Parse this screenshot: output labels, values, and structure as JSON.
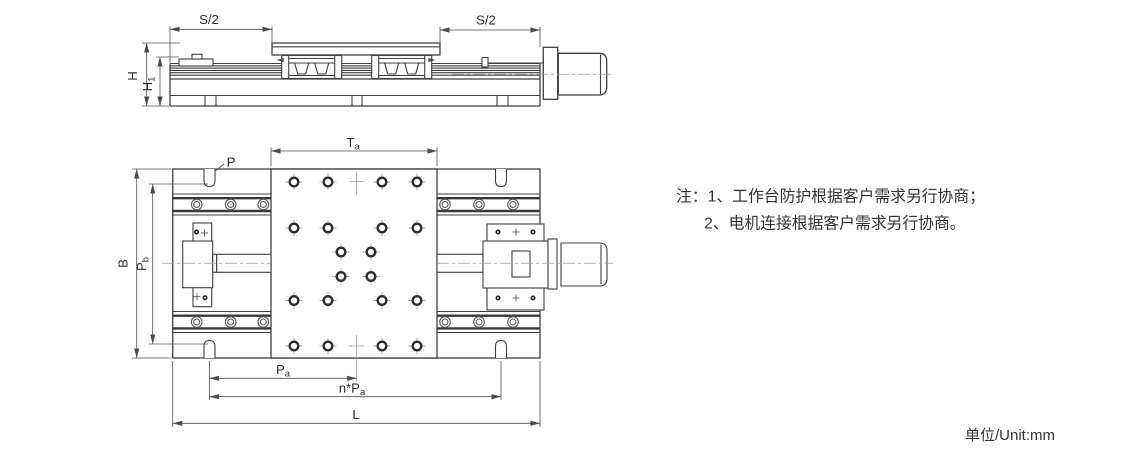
{
  "colors": {
    "line": "#3f3f3f",
    "dimension": "#4f4f4f",
    "text": "#303030",
    "centerline": "#9a9a9a",
    "background": "#ffffff"
  },
  "side_view": {
    "dims": {
      "s2_left": "S/2",
      "s2_right": "S/2",
      "h": "H",
      "h1_main": "H",
      "h1_sub": "1"
    }
  },
  "plan_view": {
    "dims": {
      "ta_main": "T",
      "ta_sub": "a",
      "p": "P",
      "b": "B",
      "pb_main": "P",
      "pb_sub": "b",
      "pa_main": "P",
      "pa_sub": "a",
      "npa_main": "n*P",
      "npa_sub": "a",
      "l": "L"
    }
  },
  "notes": {
    "line1": "注：1、工作台防护根据客户需求另行协商；",
    "line2": "2、电机连接根据客户需求另行协商。"
  },
  "footer": {
    "unit": "单位/Unit:mm"
  }
}
